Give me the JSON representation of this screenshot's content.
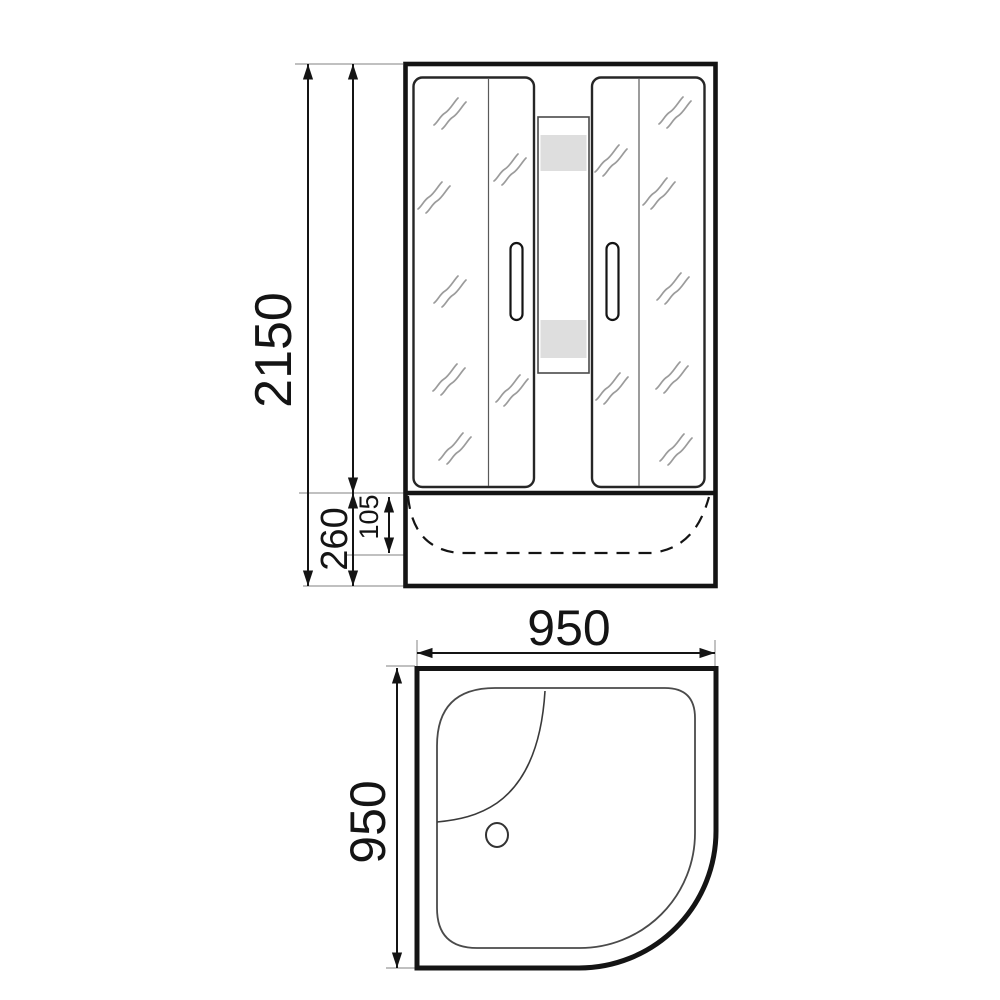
{
  "drawing": {
    "description": "Shower cabin dimensional drawing, front elevation and plan view",
    "colors": {
      "ink": "#141414",
      "extension_line": "#9a9a9a",
      "glass_mark": "#9b9b9b",
      "shelf_shade": "#dedede"
    },
    "front_view": {
      "total_height_label": "2150",
      "tray_height_label": "260",
      "tray_inner_depth_label": "105"
    },
    "plan_view": {
      "width_label": "950",
      "depth_label": "950"
    }
  }
}
